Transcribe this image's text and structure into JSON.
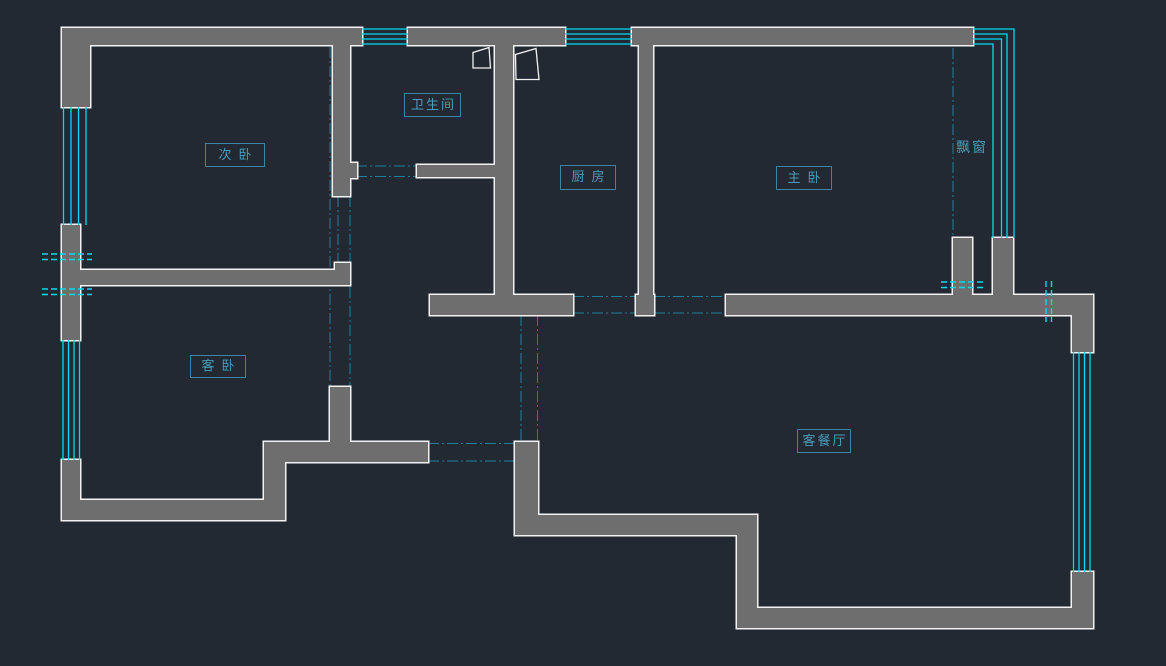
{
  "canvas": {
    "title": "apartment floor plan",
    "background": "#222933"
  },
  "colors": {
    "wall_fill": "#6e6e6e",
    "wall_outline": "#f2f2f2",
    "window_glass": "#00dcee",
    "opening_centerline": "#1e7f9b",
    "label_blue": "#4a9cba"
  },
  "rooms": [
    {
      "key": "secondary-bedroom",
      "label": "次卧"
    },
    {
      "key": "bathroom",
      "label": "卫生间"
    },
    {
      "key": "kitchen",
      "label": "厨房"
    },
    {
      "key": "master-bedroom",
      "label": "主卧"
    },
    {
      "key": "guest-bedroom",
      "label": "客卧"
    },
    {
      "key": "living-dining",
      "label": "客餐厅"
    }
  ],
  "annotations": [
    {
      "key": "bay-window",
      "label": "飘窗"
    }
  ]
}
